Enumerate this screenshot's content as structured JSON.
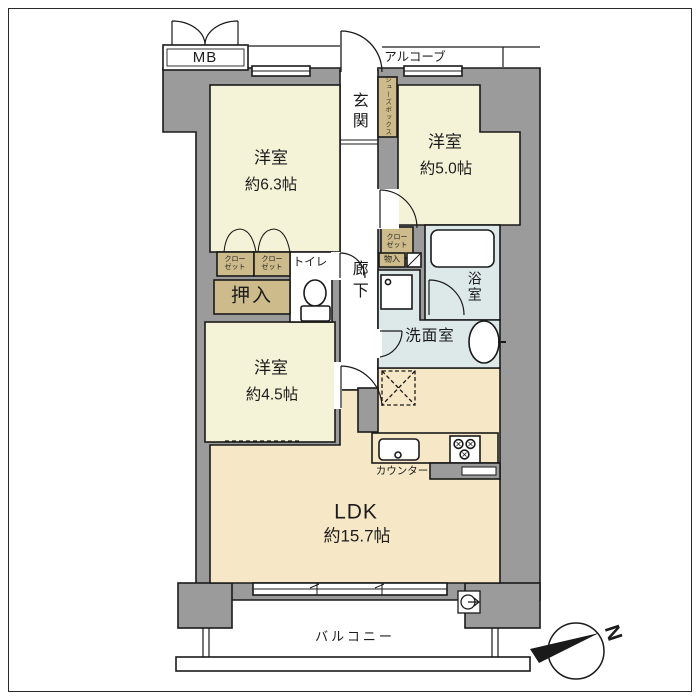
{
  "floorplan": {
    "building": {
      "mb": "MB",
      "alcove": "アルコーブ",
      "balcony": "バルコニー"
    },
    "entrance": {
      "label": "玄関",
      "shoe_box": "シューズボックス"
    },
    "corridor": "廊下",
    "rooms": [
      {
        "name": "洋室",
        "size": "約6.3帖"
      },
      {
        "name": "洋室",
        "size": "約5.0帖"
      },
      {
        "name": "洋室",
        "size": "約4.5帖"
      },
      {
        "name": "LDK",
        "size": "約15.7帖"
      }
    ],
    "sanitary": {
      "toilet": "トイレ",
      "bath": "浴室",
      "washroom": "洗面室"
    },
    "storage": {
      "closet": "クローゼット",
      "oshiire": "押入",
      "monoire": "物入"
    },
    "kitchen": {
      "counter": "カウンター"
    },
    "compass": {
      "north": "N"
    }
  },
  "colors": {
    "wall": "#9b9b9b",
    "bedroom_floor": "#f5f3d7",
    "ldk_floor": "#f6e8c6",
    "wet_floor": "#dde9e8",
    "storage_fill": "#cdbb8c",
    "line": "#1a1a1a",
    "background": "#ffffff"
  }
}
